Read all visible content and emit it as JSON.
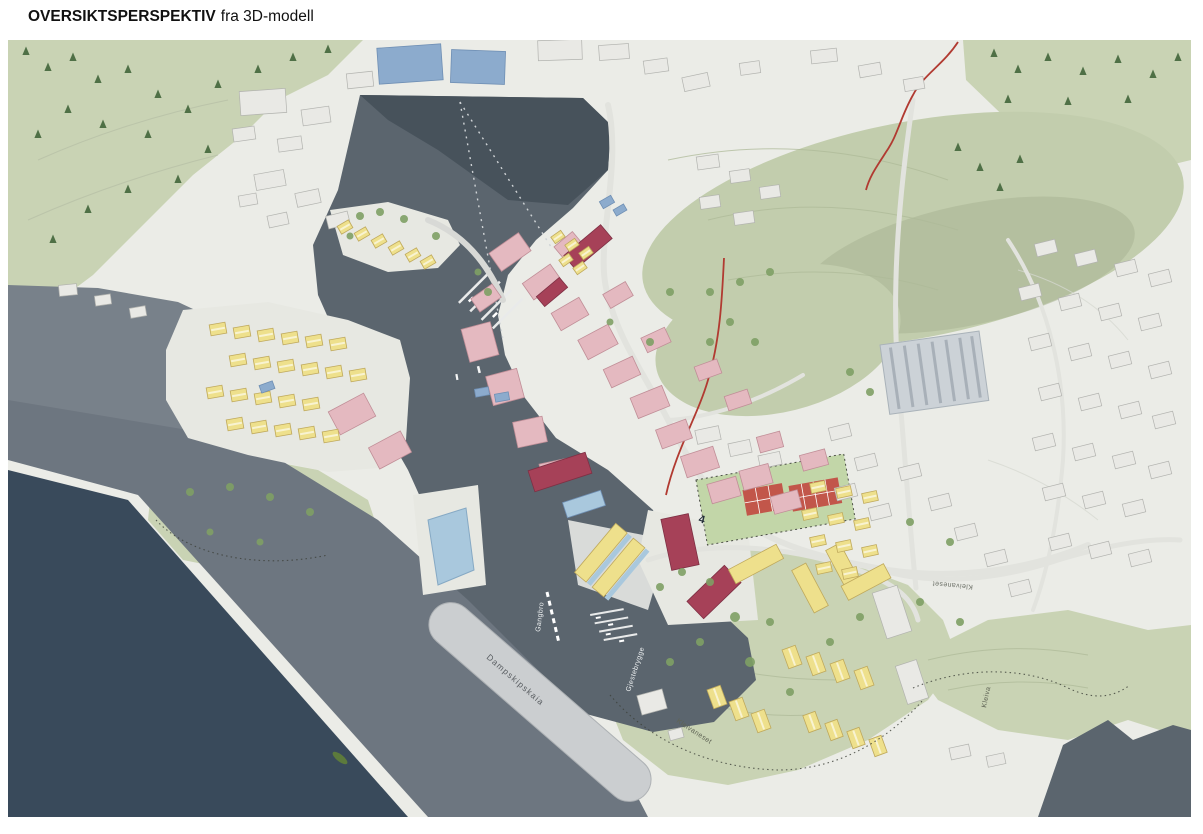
{
  "header": {
    "title_bold": "OVERSIKTSPERSPEKTIV",
    "title_regular": "fra 3D-modell"
  },
  "map": {
    "description": "Oversiktsperspektiv fra 3D-modell av kystby med fjord, havn og fargede bygningsvolumer",
    "labels": {
      "gangbro": "Gangbro",
      "gjestebrygge": "Gjestebrygge",
      "dampskipskaia": "Dampskipskaia",
      "kleivaneset_road": "Kleivaneset",
      "kleivaneset_park": "Kleivaneset",
      "kleiva": "Kleiva",
      "marker_4": "4"
    },
    "colors": {
      "water_dark": "#394a5b",
      "water_dark_top": "#47525b",
      "water_harbor": "#5b656e",
      "water_mid": "#6d7680",
      "water_light": "#78818a",
      "terrain": "#ebece7",
      "terrain_green": "#c9d3b4",
      "mountain_green": "#c2cdad",
      "green_shade": "#a9b593",
      "forest_green": "#4f7046",
      "tree_green": "#7fa065",
      "building_gray": "#e9e9e5",
      "building_pink": "#e4b9c0",
      "building_red": "#a64158",
      "building_yellow": "#eee08c",
      "building_blue": "#8cabcd",
      "building_lightblue": "#a9c8dd",
      "pier": "#cbced0",
      "court": "#c2564a",
      "road_red": "#b13a31",
      "label_light": "#eef1f2",
      "label_dark": "#5f6455"
    }
  }
}
